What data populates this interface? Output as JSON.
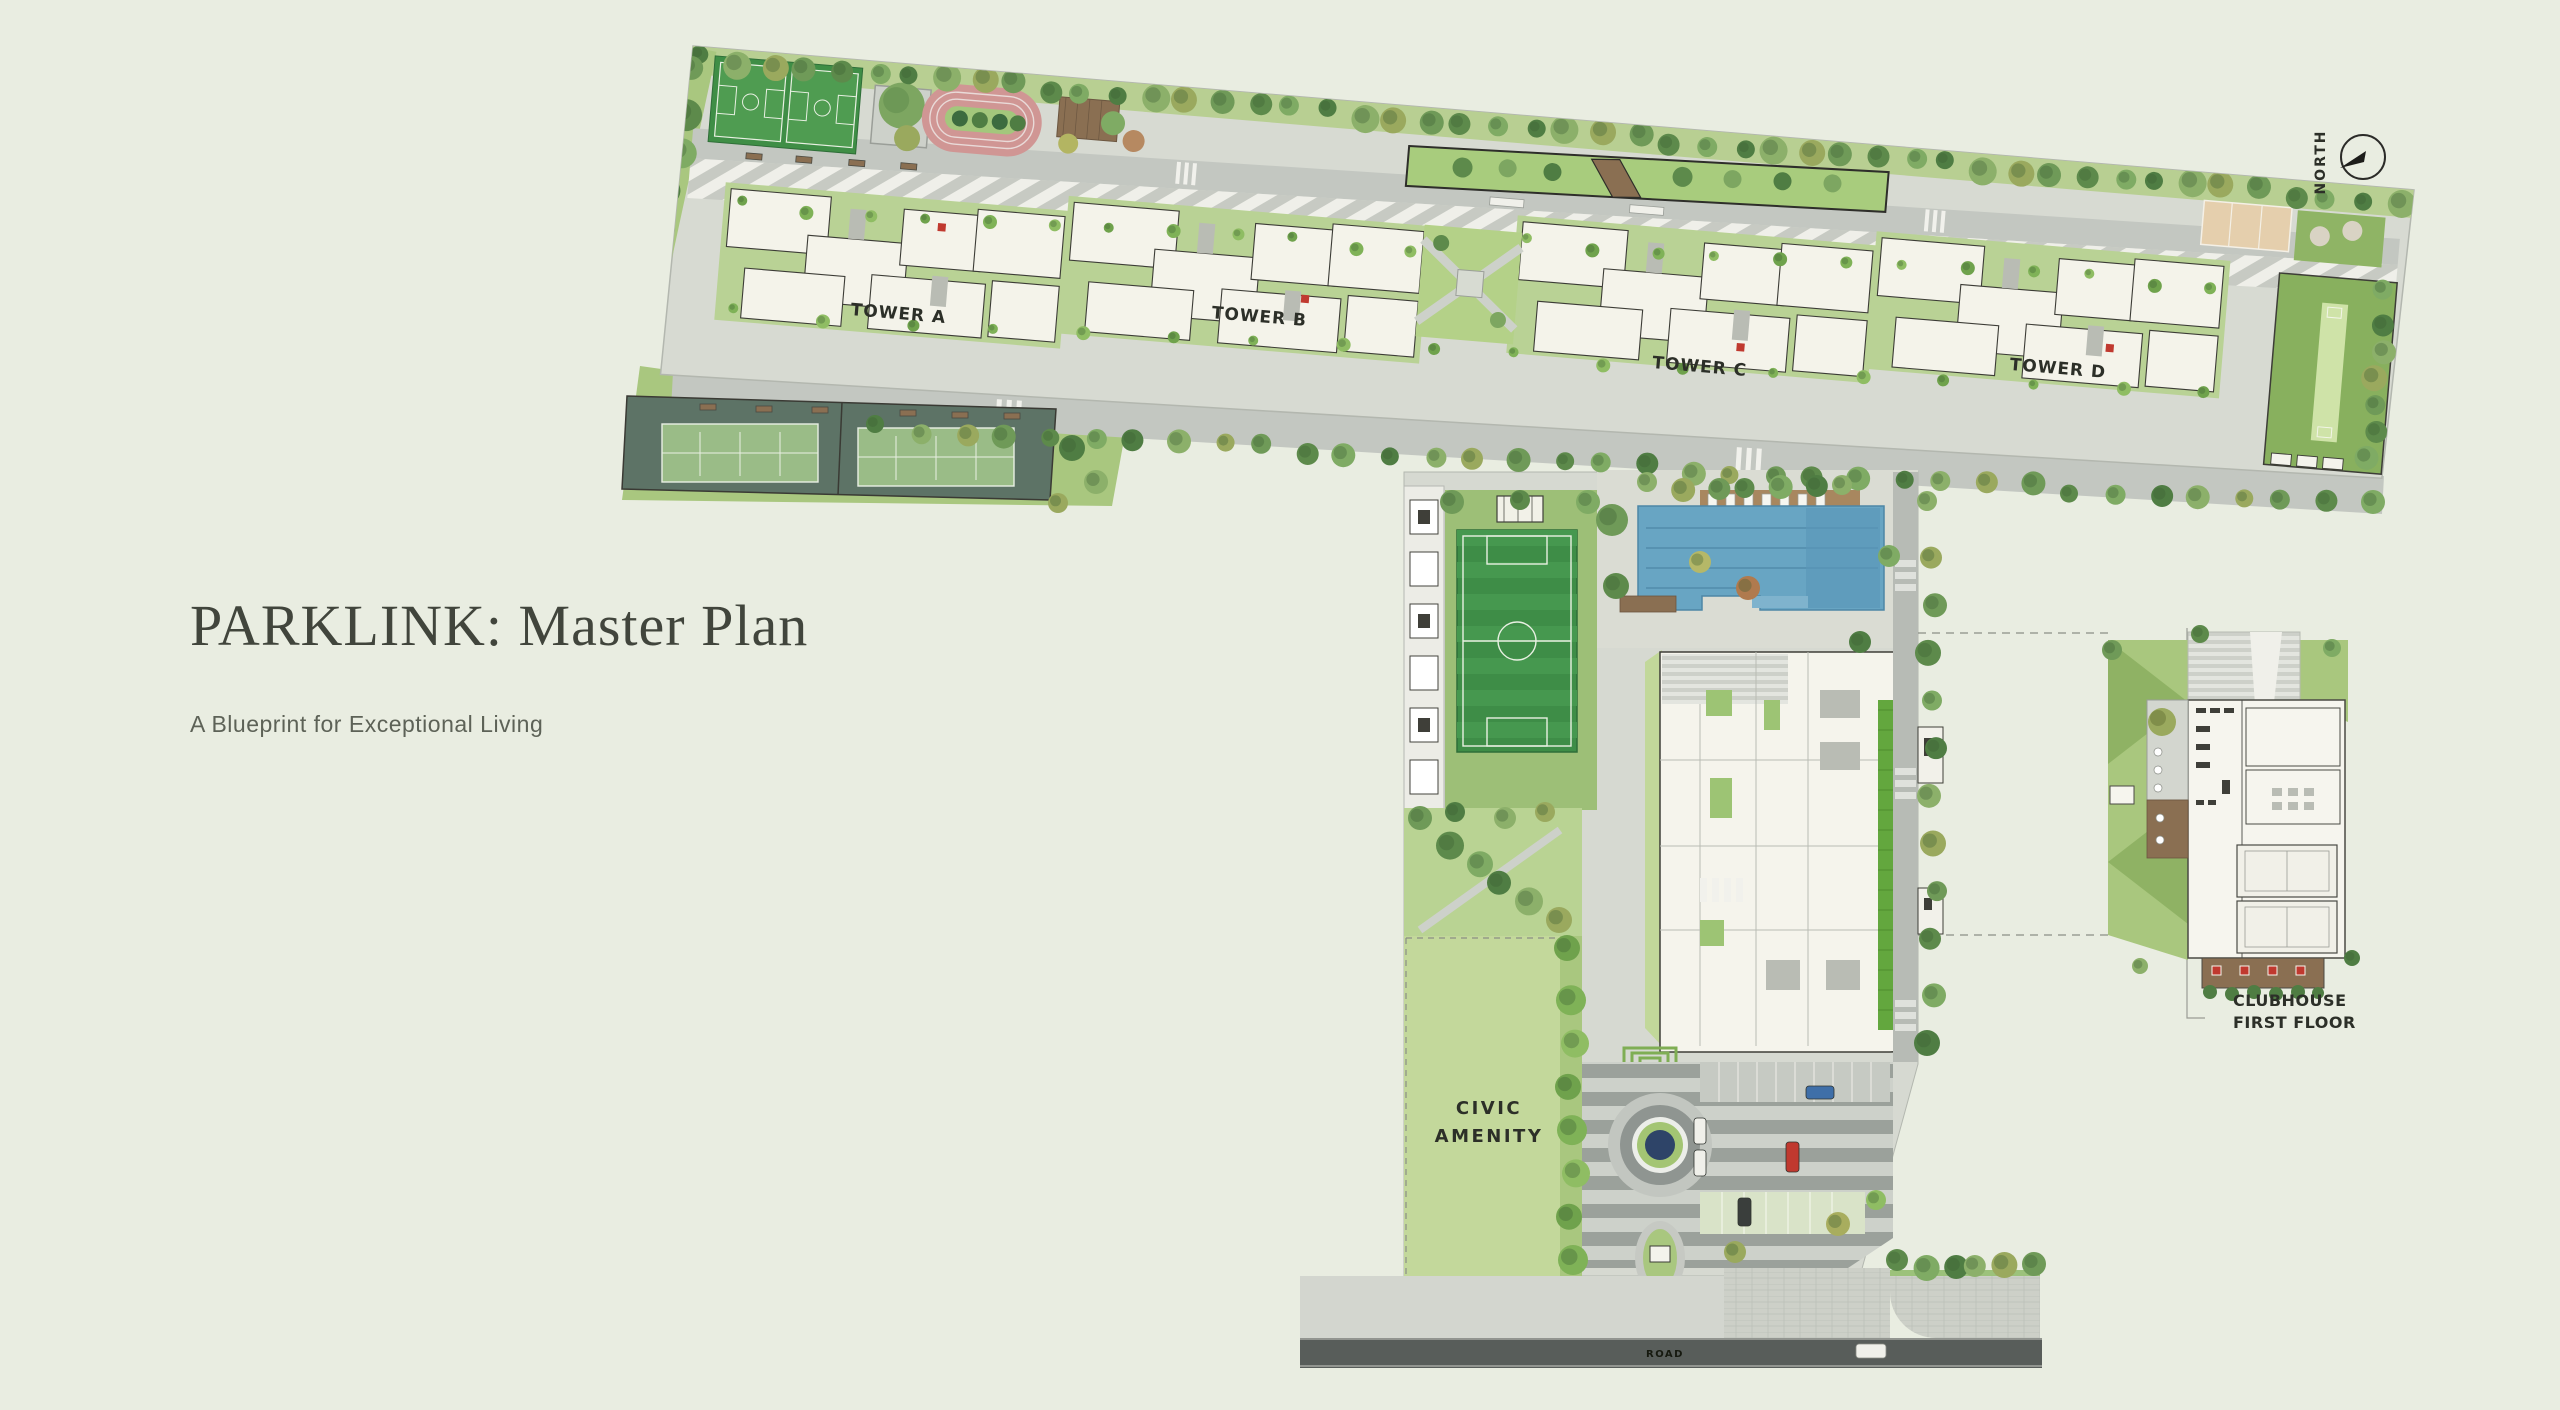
{
  "page": {
    "background_color": "#e9ede1"
  },
  "header": {
    "title": "PARKLINK: Master Plan",
    "subtitle": "A Blueprint for Exceptional Living"
  },
  "plan": {
    "north_label": "NORTH",
    "towers": [
      {
        "label": "TOWER A"
      },
      {
        "label": "TOWER B"
      },
      {
        "label": "TOWER C"
      },
      {
        "label": "TOWER D"
      }
    ],
    "civic_amenity": {
      "line1": "CIVIC",
      "line2": "AMENITY"
    },
    "clubhouse_callout": {
      "line1": "CLUBHOUSE",
      "line2": "FIRST FLOOR"
    },
    "gate": {
      "entry_label": "ENTRY",
      "exit_label": "EXIT"
    },
    "road_label": "ROAD",
    "amenities": [
      "basketball courts",
      "running track",
      "tennis courts",
      "cricket lawn",
      "volleyball court",
      "football pitch",
      "swimming pool",
      "clubhouse",
      "roundabout",
      "civic amenity lawn",
      "entry exit gate"
    ],
    "colors": {
      "canvas_bg": "#e9ede1",
      "lawn_green": "#c3d89b",
      "podium_green": "#a9c77f",
      "pool_blue": "#68a5c3",
      "pitch_green": "#3e8d47",
      "track_pink": "#d09694",
      "tennis_green": "#9abc87",
      "tennis_enclosure": "#5d7366",
      "court_tan": "#e5cfad",
      "road_gray": "#c3c7c1",
      "asphalt_dark": "#585d5a",
      "building_white": "#f4f3ea",
      "accent_red": "#c0392f",
      "navy_water": "#2e4468"
    }
  }
}
